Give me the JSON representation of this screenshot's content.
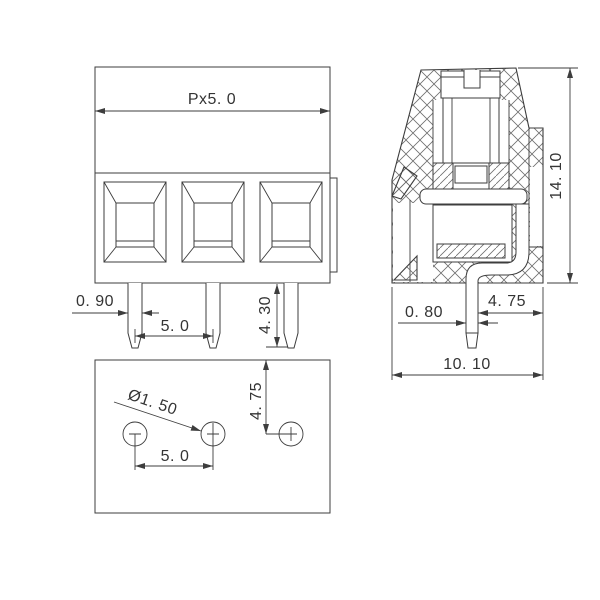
{
  "drawing_type": "terminal-block-dimension-drawing",
  "colors": {
    "line": "#3d3d3d",
    "text": "#343434",
    "background": "#ffffff"
  },
  "dims": {
    "front": {
      "pitch_total": "Px5. 0",
      "pin_width": "0. 90",
      "pin_pitch": "5. 0",
      "pin_length": "4. 30"
    },
    "bottom": {
      "hole_diameter": "Ø1. 50",
      "hole_pitch": "5. 0",
      "edge_to_hole": "4. 75"
    },
    "side": {
      "overall_height": "14. 10",
      "pin_to_edge": "4. 75",
      "pin_thickness": "0. 80",
      "overall_depth": "10. 10"
    }
  }
}
